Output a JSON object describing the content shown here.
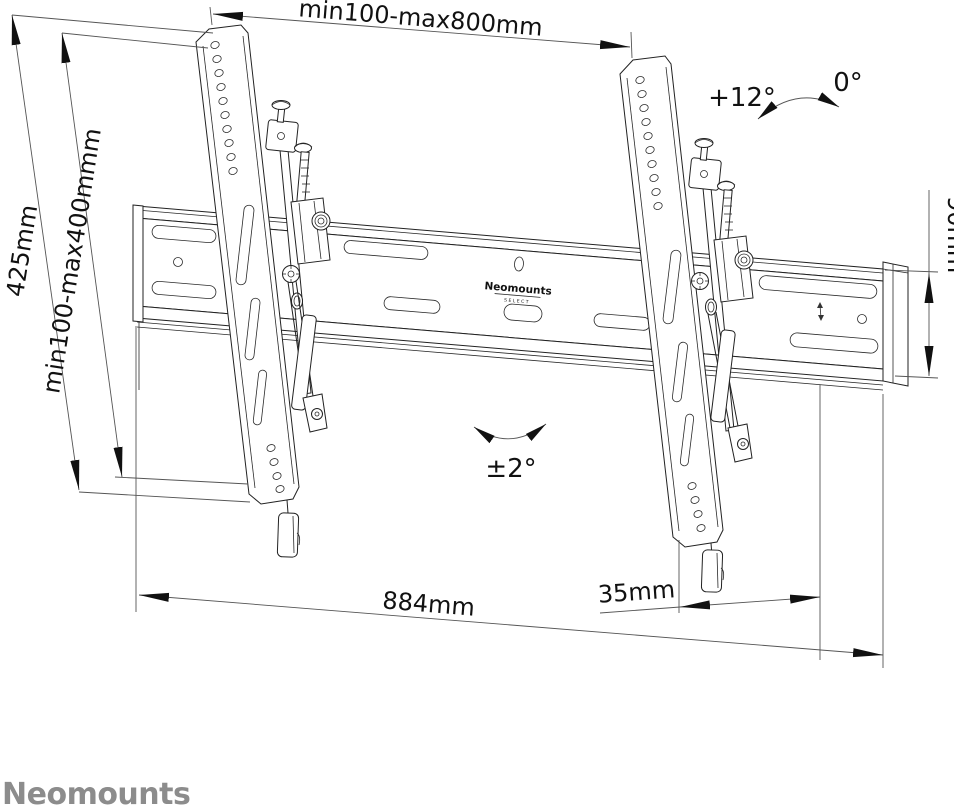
{
  "drawing": {
    "title_hint": "tilting tv wall mount dimensional drawing",
    "colors": {
      "background": "#ffffff",
      "line": "#222222",
      "logo_gray": "#8c8c8c"
    },
    "dimensions": {
      "top_width": "min100-max800mm",
      "left_outer_height": "425mm",
      "left_inner_height": "min100-max400mmm",
      "right_height": "90mm",
      "bottom_width": "884mm",
      "bottom_offset": "35mm"
    },
    "angles": {
      "tilt_max": "+12°",
      "tilt_zero": "0°",
      "level_adjust": "±2°"
    },
    "rail_label": {
      "brand": "Neomounts",
      "sub": "SELECT"
    },
    "brand_logo": "Neomounts"
  }
}
